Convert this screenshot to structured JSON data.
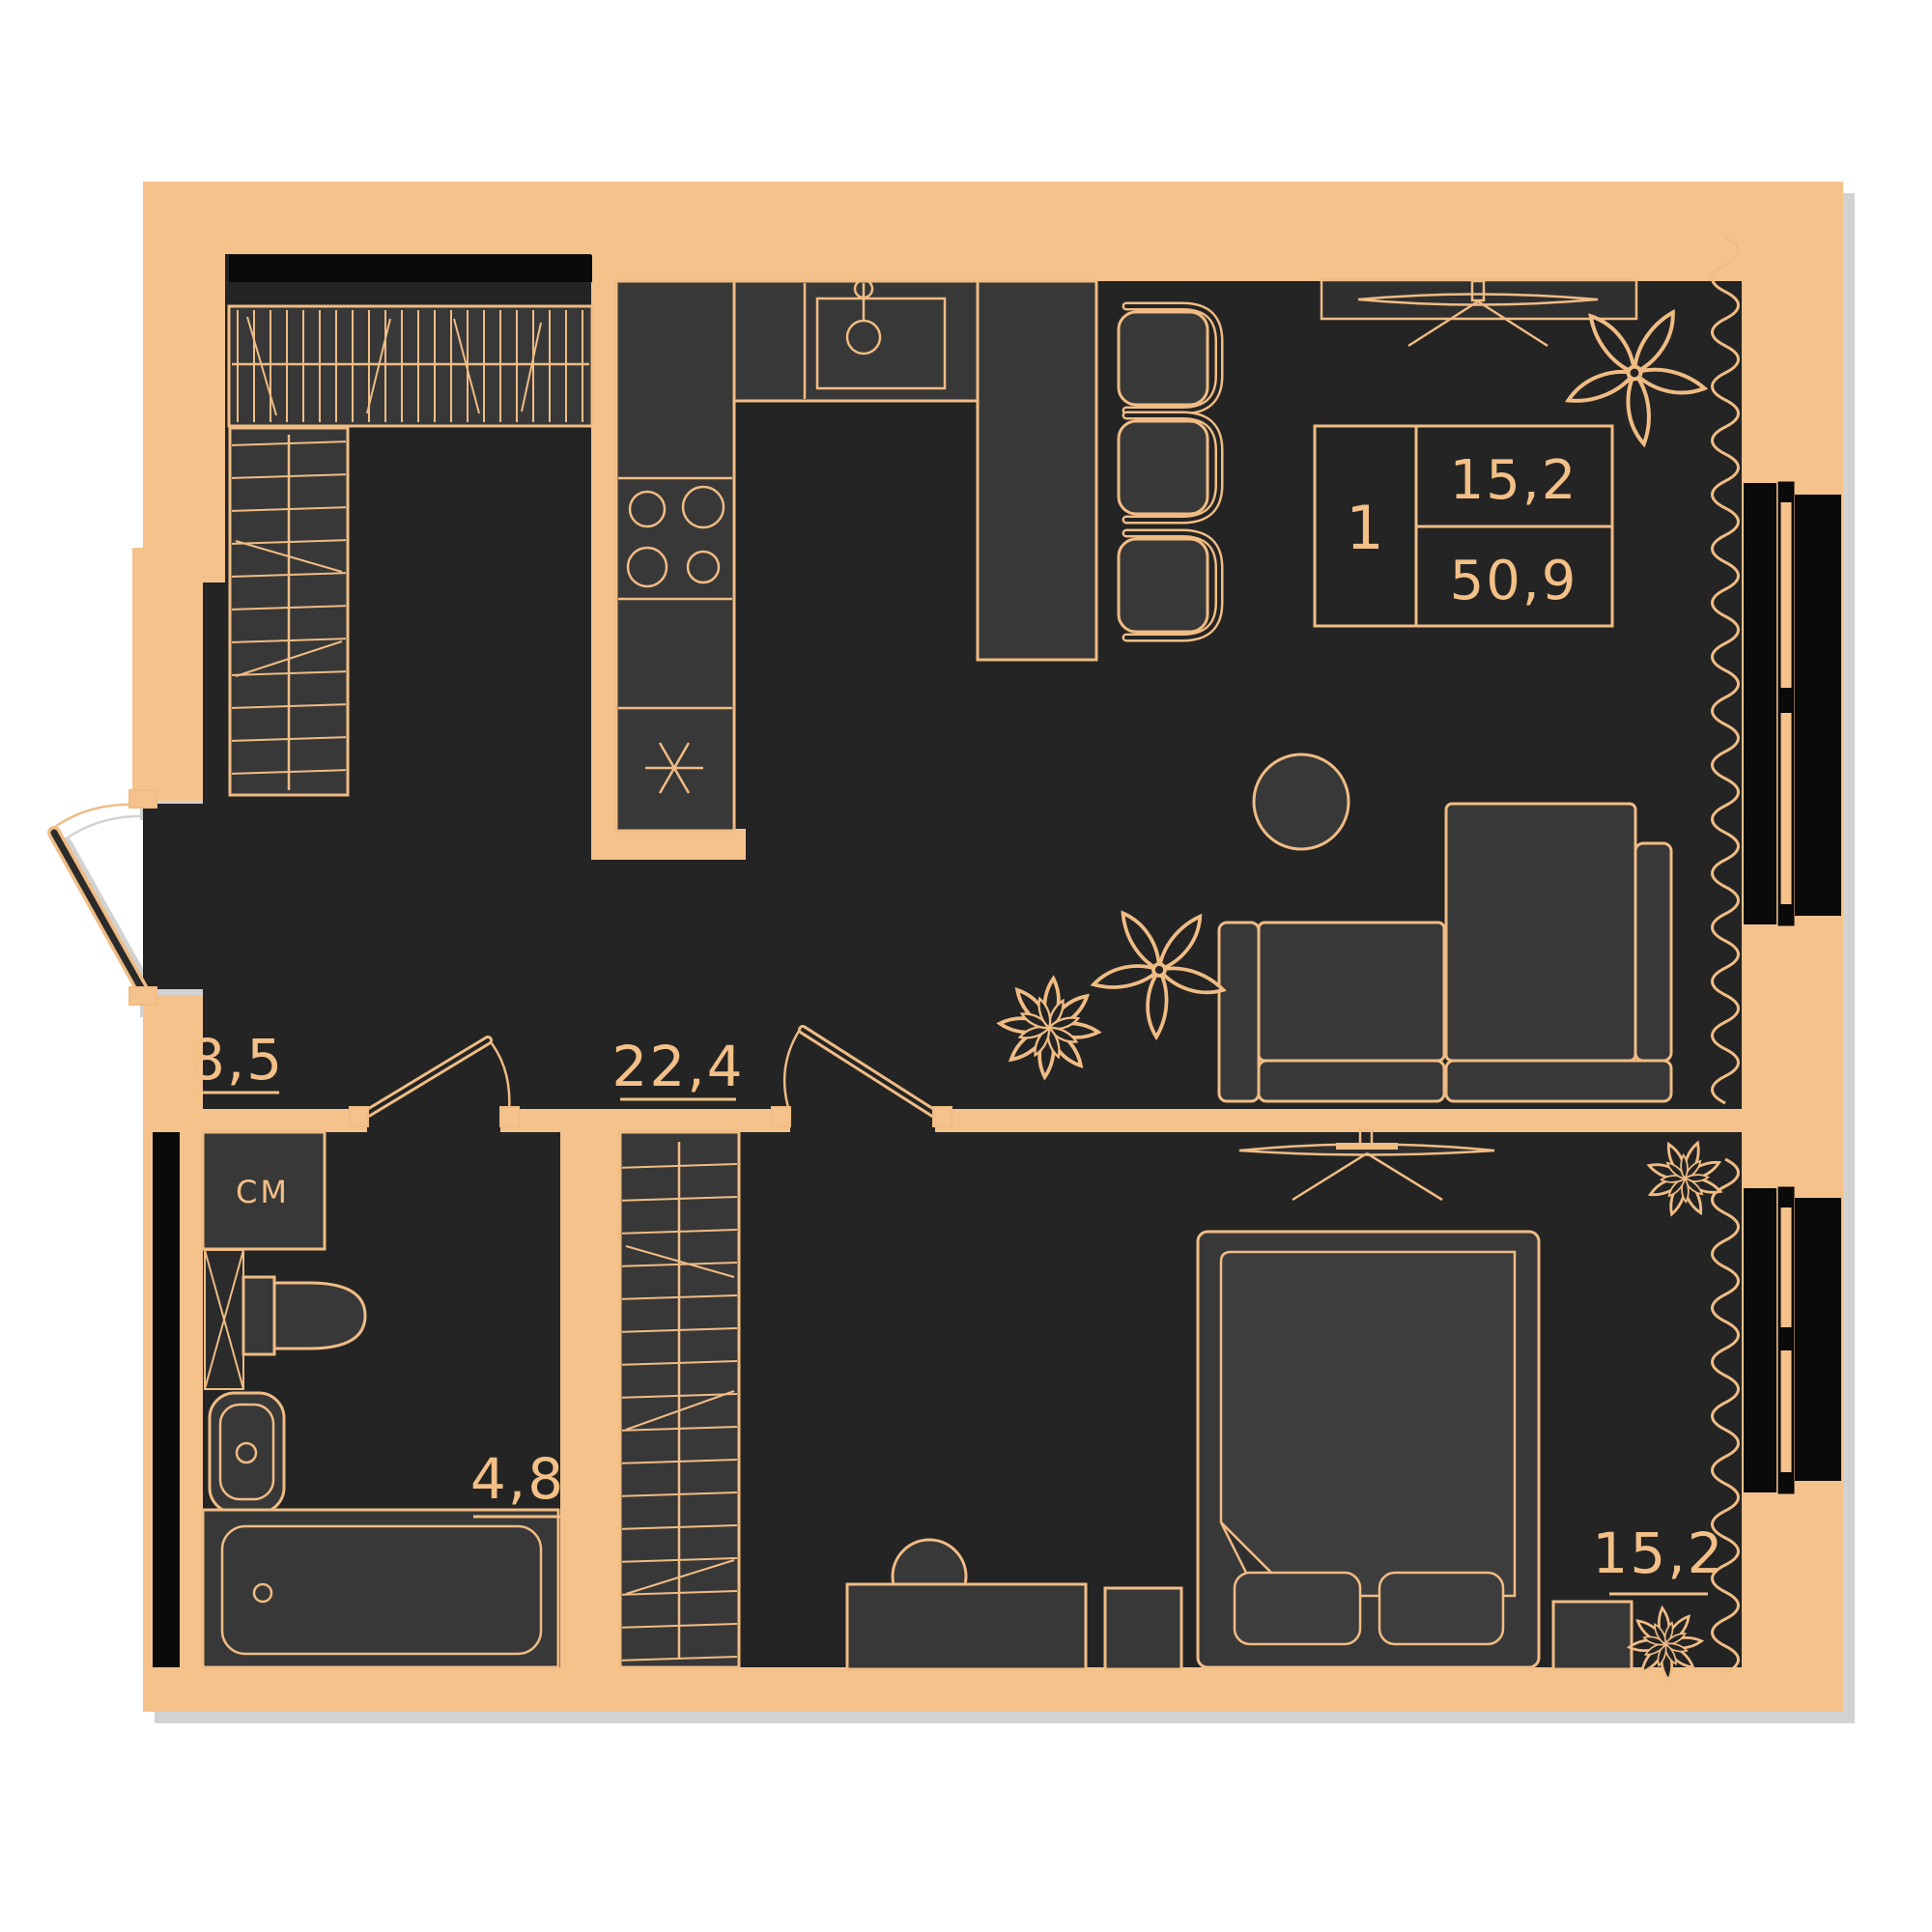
{
  "palette": {
    "background": "#ffffff",
    "wall": "#f5c28c",
    "outline": "#f0bc84",
    "room_floor": "#242424",
    "furniture": "#383838",
    "furniture_dark": "#2f2f2f",
    "window_black": "#0a0a0a",
    "shadow": "#d2d2d2",
    "text": "#f3c088"
  },
  "info_box": {
    "rooms": "1",
    "living_area": "15,2",
    "total_area": "50,9"
  },
  "rooms": {
    "hallway": {
      "area": "8,5"
    },
    "kitchen_living": {
      "area": "22,4"
    },
    "bathroom": {
      "area": "4,8"
    },
    "bedroom": {
      "area": "15,2"
    }
  },
  "appliances": {
    "washing_machine": "СМ"
  }
}
